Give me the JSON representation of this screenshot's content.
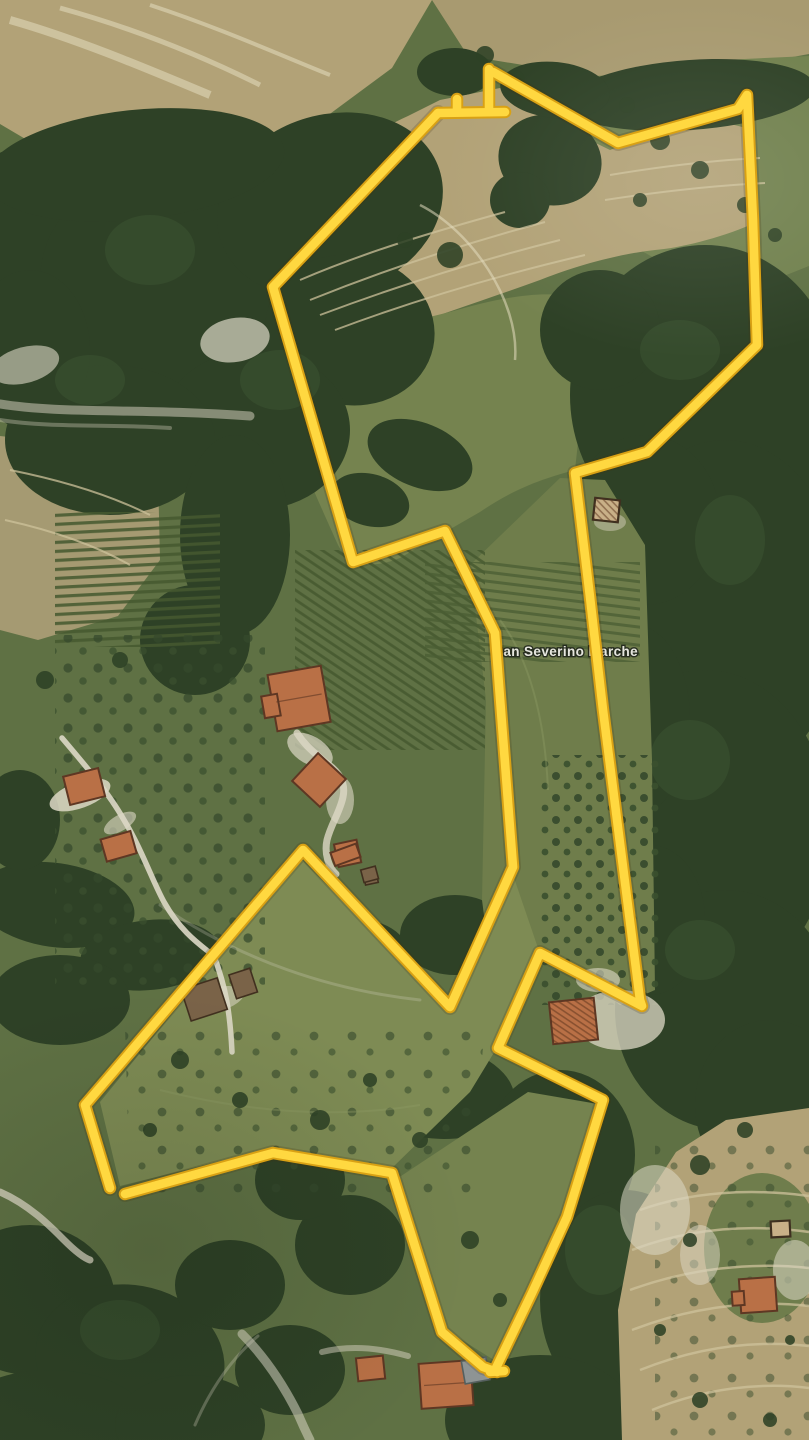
{
  "map": {
    "place_label": "San Severino Marche"
  },
  "theme": {
    "boundary-yellow": "#FFD840",
    "boundary-edge": "#D9A114",
    "label-color": "#F2F1EC",
    "label-halo": "#22281D",
    "forest-dark": "#2E4126",
    "forest-mid": "#46603A",
    "meadow": "#75834F",
    "meadow-light": "#7E8B54",
    "meadow-dark": "#6F7D4B",
    "field-green": "#5F7144",
    "tan": "#B2A277",
    "tan-light": "#CDC19B",
    "tan-dark": "#A89A70",
    "road-white": "#DDD8C6",
    "roof-orange": "#B97046",
    "roof-dark": "#5E3723",
    "roof-grey": "#8E9494"
  },
  "boundary": {
    "left_chain": "438,113 273,287 353,562 445,531 495,633 513,867 450,1007 303,850 85,1105 110,1188",
    "bottom_chain": "125,1194 273,1153 392,1173 442,1332 483,1367 497,1372",
    "right_chain": "493,72 618,143 738,109 747,95 753,220 757,345 647,452 575,473 590,597 603,710 640,1000 642,1006 540,953 498,1048 603,1100 567,1217 532,1293 495,1370",
    "top_bar": "438,113 505,112",
    "top_tick": "457,111 457,99",
    "top_stub": "489,111 489,69",
    "close_tail": "490,1372 504,1371"
  }
}
